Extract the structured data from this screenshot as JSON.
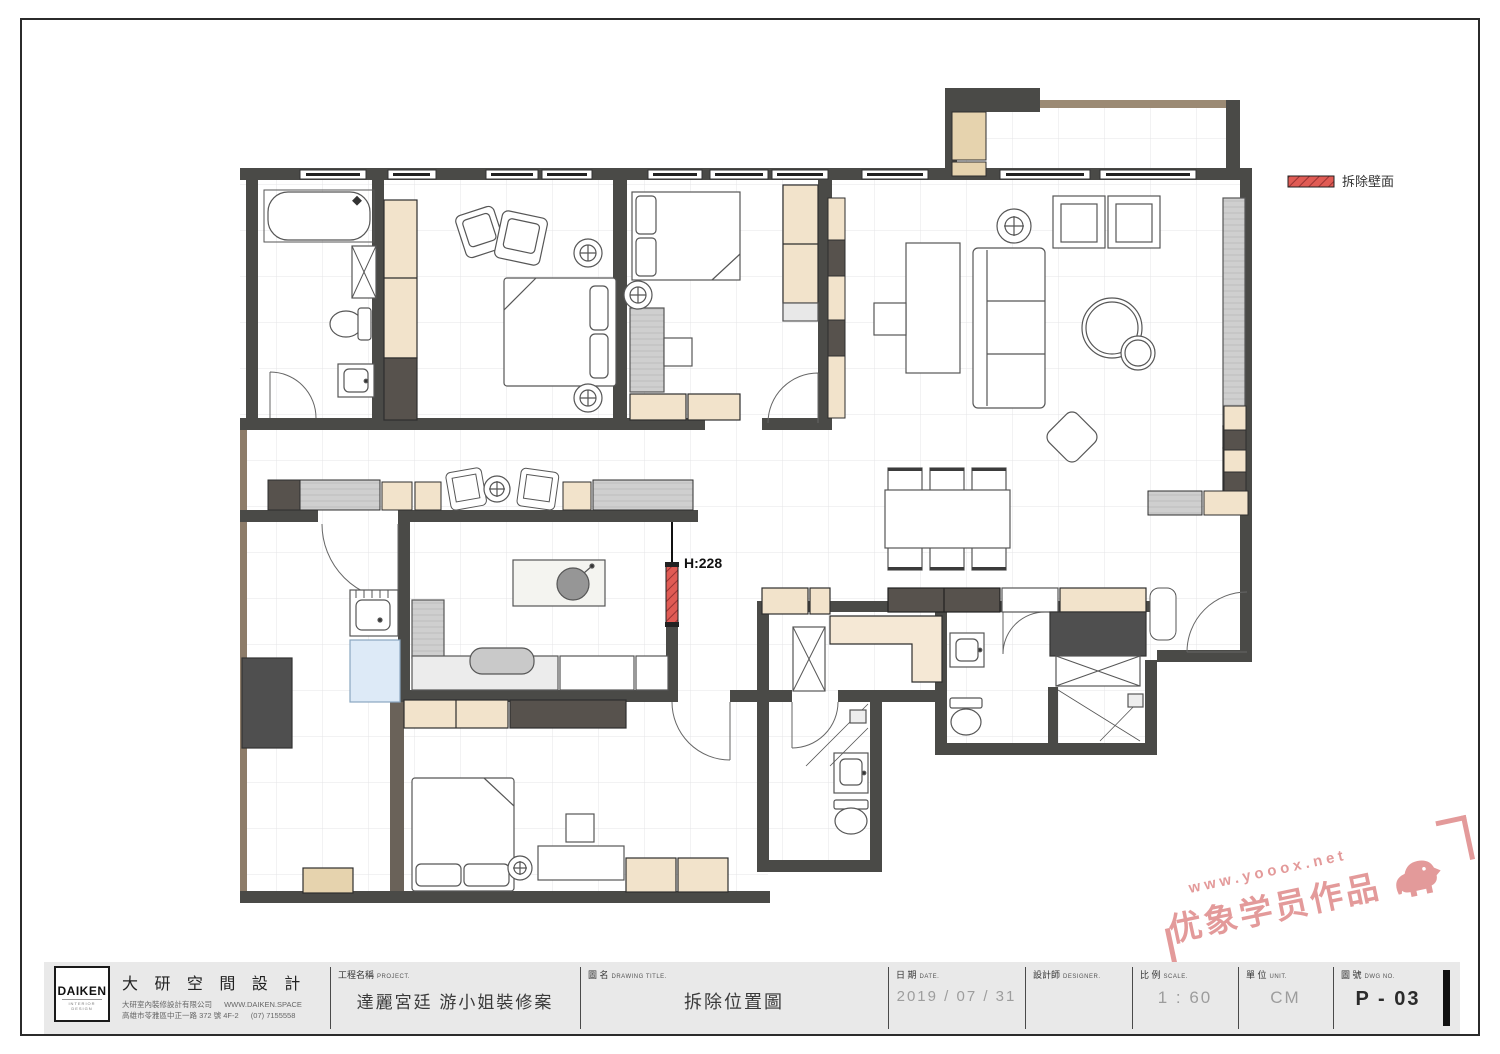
{
  "legend": {
    "demolish_label": "拆除壁面"
  },
  "plan": {
    "height_note": "H:228"
  },
  "colors": {
    "wall": "#4a4a47",
    "demolish_red": "#e05b54",
    "cabinet_beige": "#f2e3cb",
    "wood_dark": "#57524d",
    "wood_strip": "#9b8a74",
    "watermark_pink": "#dd8181",
    "washer_blue": "#ddeaf7"
  },
  "watermark": {
    "url": "www.yooox.net",
    "text": "优象学员作品"
  },
  "titleblock": {
    "logo": {
      "name": "DAIKEN",
      "subtitle": "INTERIOR DESIGN"
    },
    "company": {
      "name": "大 研 空 間 設 計",
      "line1": "大研室內裝修設計有限公司",
      "line2": "高雄市苓雅區中正一路 372 號 4F-2",
      "website": "WWW.DAIKEN.SPACE",
      "phone": "(07) 7155558"
    },
    "fields": [
      {
        "label": "工程名稱",
        "label_en": "PROJECT.",
        "value": "達麗宮廷 游小姐裝修案"
      },
      {
        "label": "圖 名",
        "label_en": "DRAWING TITLE.",
        "value": "拆除位置圖"
      },
      {
        "label": "日 期",
        "label_en": "DATE.",
        "value": "2019 / 07 / 31"
      },
      {
        "label": "設計師",
        "label_en": "DESIGNER.",
        "value": ""
      },
      {
        "label": "比 例",
        "label_en": "SCALE.",
        "value": "1 : 60"
      },
      {
        "label": "單 位",
        "label_en": "UNIT.",
        "value": "CM"
      },
      {
        "label": "圖 號",
        "label_en": "DWG NO.",
        "value": "P - 03"
      }
    ]
  }
}
